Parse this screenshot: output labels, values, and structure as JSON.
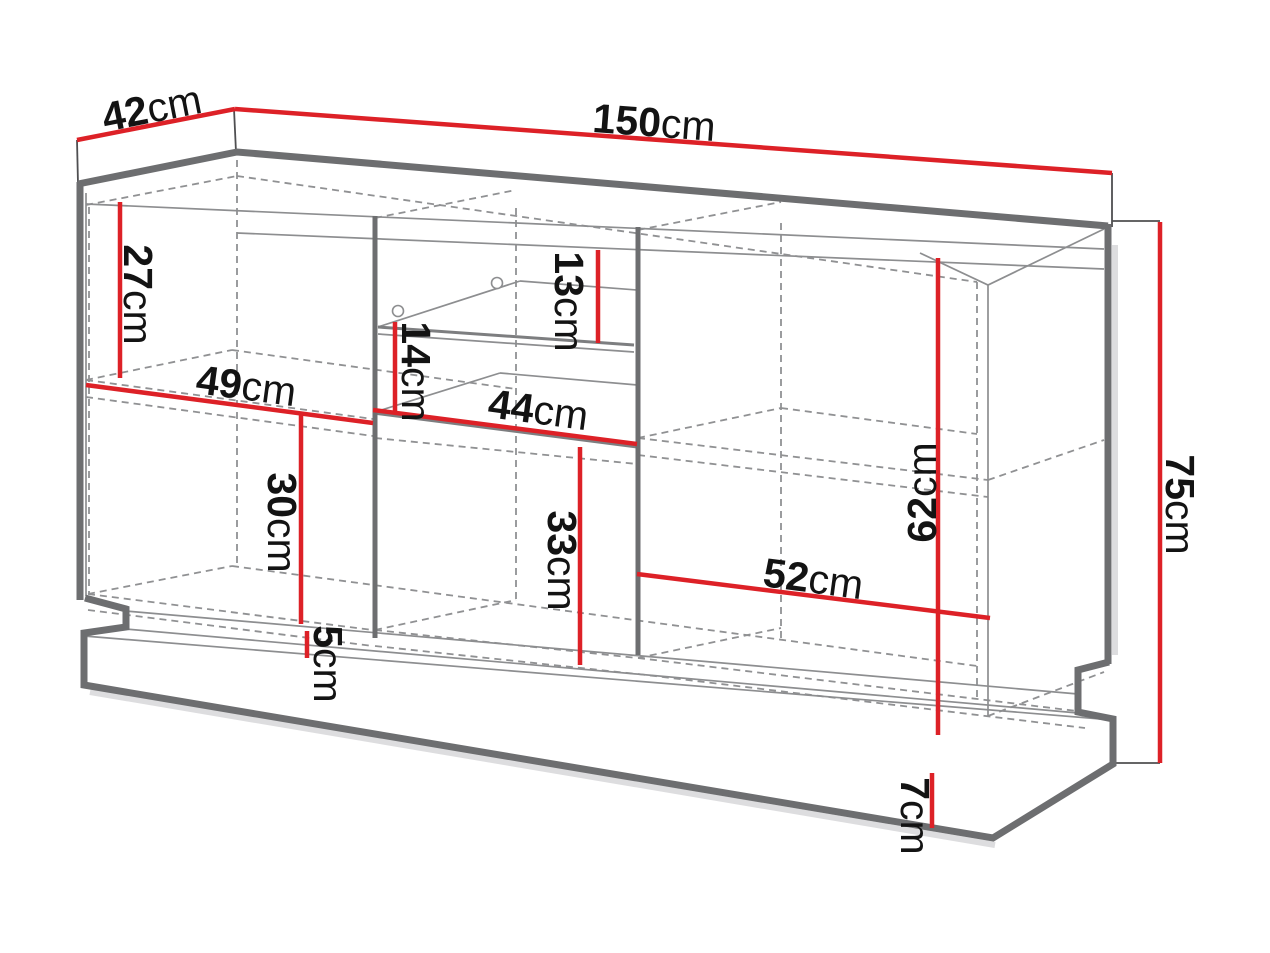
{
  "diagram": {
    "type": "furniture-dimension-drawing",
    "unit": "cm",
    "colors": {
      "dimension_line": "#dd2127",
      "outline_thick": "#6d6e70",
      "outline_medium": "#7d7e80",
      "outline_thin": "#8d8e90",
      "hidden_line": "#909193",
      "tick_line": "#4f4f51",
      "label_text": "#131313",
      "background": "#ffffff"
    },
    "dimensions": {
      "top_depth": {
        "value": "42",
        "unit": "cm"
      },
      "top_width": {
        "value": "150",
        "unit": "cm"
      },
      "total_height": {
        "value": "75",
        "unit": "cm"
      },
      "left_upper_inner_height": {
        "value": "27",
        "unit": "cm"
      },
      "left_shelf_width": {
        "value": "49",
        "unit": "cm"
      },
      "left_lower_inner_height": {
        "value": "30",
        "unit": "cm"
      },
      "glass_shelf_clearance": {
        "value": "14",
        "unit": "cm"
      },
      "glass_niche_upper_height": {
        "value": "13",
        "unit": "cm"
      },
      "middle_shelf_width": {
        "value": "44",
        "unit": "cm"
      },
      "middle_lower_inner_height": {
        "value": "33",
        "unit": "cm"
      },
      "right_inner_height": {
        "value": "62",
        "unit": "cm"
      },
      "right_shelf_width": {
        "value": "52",
        "unit": "cm"
      },
      "plinth_recess_height": {
        "value": "5",
        "unit": "cm"
      },
      "base_height": {
        "value": "7",
        "unit": "cm"
      }
    }
  }
}
